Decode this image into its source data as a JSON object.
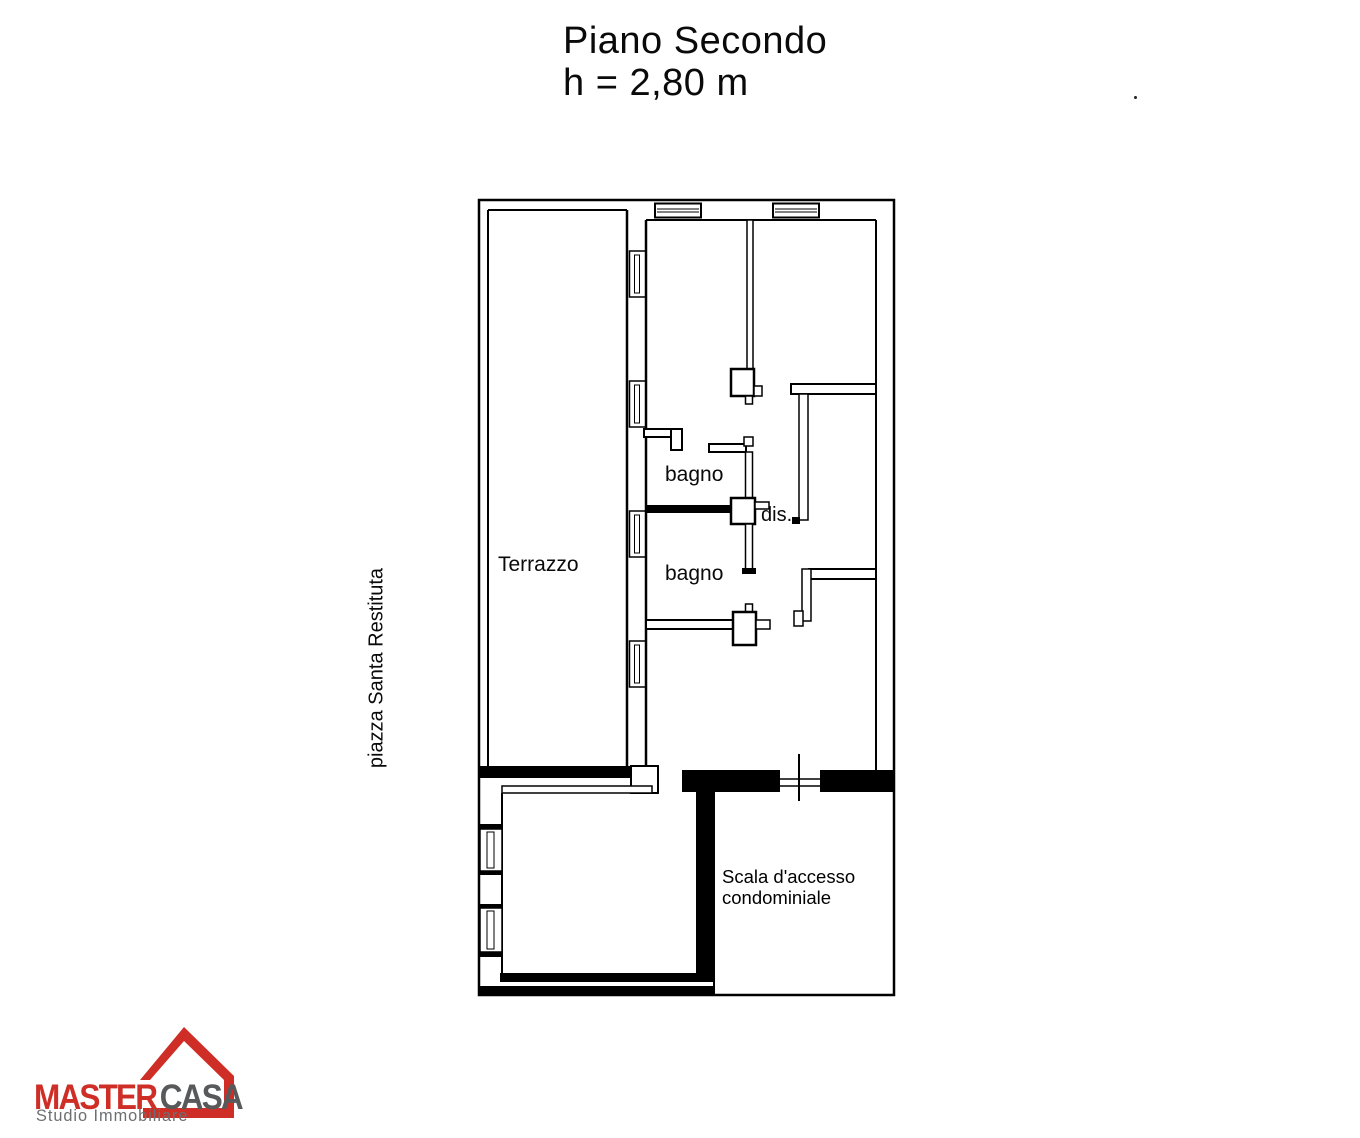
{
  "title": {
    "line1": "Piano Secondo",
    "line2": "h = 2,80 m"
  },
  "floor_plan": {
    "rooms": {
      "terrazzo": "Terrazzo",
      "bagno_1": "bagno",
      "dis": "dis.",
      "bagno_2": "bagno",
      "scala_line1": "Scala d'accesso",
      "scala_line2": "condominiale"
    },
    "street_label": "piazza Santa Restituta"
  },
  "logo": {
    "brand_part1": "MASTER",
    "brand_part2": "CASA",
    "tagline": "Studio Immobiliare",
    "colors": {
      "red": "#cf2e27",
      "gray": "#58595b"
    }
  },
  "colors": {
    "wall": "#000000",
    "background": "#ffffff"
  }
}
